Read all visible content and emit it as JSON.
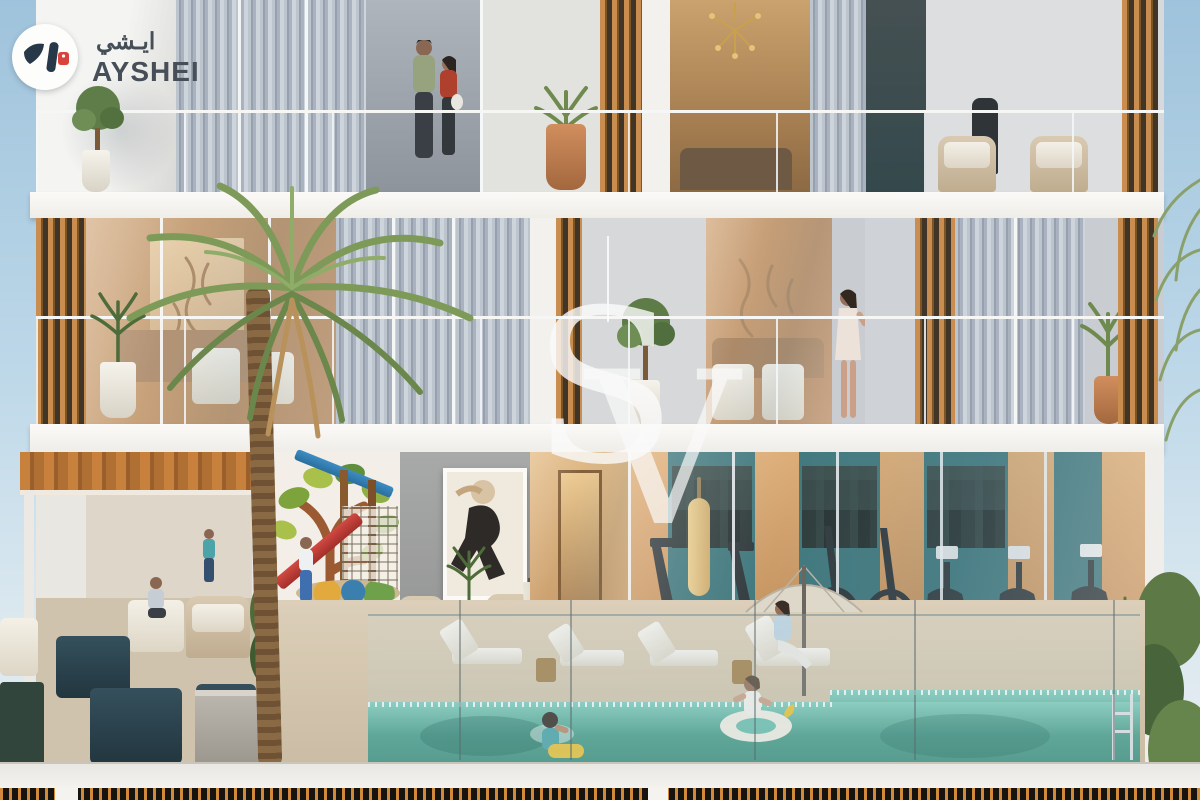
{
  "canvas": {
    "width": 1200,
    "height": 800
  },
  "branding": {
    "logo_arabic": "ايـشي",
    "logo_latin": "AYSHEI"
  },
  "watermark": {
    "letter_s": "S",
    "letter_v": "V"
  },
  "scene": {
    "type": "architectural-rendering",
    "subject": "residential building cutaway elevation with amenity podium",
    "floors": [
      {
        "name": "upper-residence",
        "features": [
          "couple on balcony",
          "curtained glazing",
          "timber louvers",
          "potted plants",
          "rattan armchairs",
          "gold pendant light"
        ]
      },
      {
        "name": "middle-residence",
        "features": [
          "warm living interiors with wall murals",
          "woman on balcony",
          "tall palm tree",
          "glass balustrades",
          "balcony trees"
        ]
      },
      {
        "name": "amenity-level",
        "features": [
          "timber pergola lounge",
          "kids playground with tree mural and red slide",
          "framed abstract wall art",
          "cafe interior",
          "glass-fronted gym with teal wall and equipment",
          "pool deck with sun loungers and umbrellas",
          "swimming pool with swimmer and child on float",
          "planter pots",
          "timber privacy fence"
        ]
      }
    ],
    "palette": {
      "sky": "#b7d2e4",
      "slab_white": "#f5f4f1",
      "timber": "#c98e4f",
      "curtain_gray": "#9aa5b2",
      "gym_teal": "#2f6b70",
      "pool_water": "#5fb7a4",
      "deck": "#d5c8b2",
      "accent_red": "#c23b36",
      "mural_green": "#7da33c",
      "logo_tag_red": "#d8433b",
      "logo_text": "#464e57"
    }
  }
}
